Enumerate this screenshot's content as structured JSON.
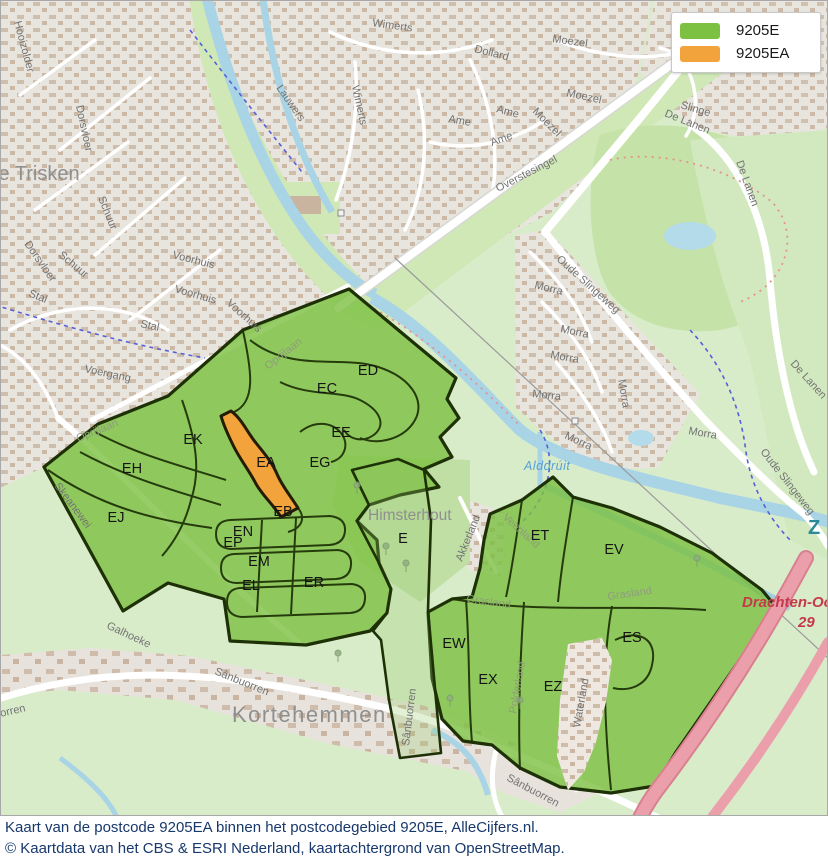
{
  "legend": {
    "items": [
      {
        "label": "9205E",
        "color": "#7cc141"
      },
      {
        "label": "9205EA",
        "color": "#f2a33c"
      }
    ]
  },
  "caption": {
    "line1": "Kaart van de postcode 9205EA binnen het postcodegebied 9205E, AlleCijfers.nl.",
    "line2": "© Kaartdata van het CBS & ESRI Nederland, kaartachtergrond van OpenStreetMap."
  },
  "map": {
    "regions": {
      "ed": "ED",
      "ec": "EC",
      "ee": "EE",
      "ek": "EK",
      "eh": "EH",
      "ej": "EJ",
      "ea": "EA",
      "eg": "EG",
      "eb": "EB",
      "en": "EN",
      "ep": "EP",
      "em": "EM",
      "el": "EL",
      "er": "ER",
      "e": "E",
      "et": "ET",
      "ev": "EV",
      "ew": "EW",
      "ex": "EX",
      "ez": "EZ",
      "es": "ES"
    },
    "places": {
      "de_trisken": "De Trisken",
      "himsterhout": "Himsterhout",
      "kortehemmen": "Kortehemmen",
      "z": "Z"
    },
    "water": {
      "alddruit": "Alddrúit"
    },
    "motorway": {
      "name": "Drachten-Oost",
      "exit": "29"
    },
    "streets": {
      "hooizolder": "Hooizolder",
      "slinge_a": "Slinge",
      "slinge_b": "Slinge",
      "wimerts_a": "Wimerts",
      "wimerts_b": "Wimerts",
      "lauwers": "Lauwers",
      "dollard": "Dollard",
      "moezel_a": "Moezel",
      "moezel_b": "Moezel",
      "moezel_c": "Moezel",
      "ame_a": "Ame",
      "ame_b": "Ame",
      "ame_c": "Ame",
      "overstesingel": "Overstesingel",
      "dorsvloer_a": "Dorsvloer",
      "dorsvloer_b": "Dorsvloer",
      "schuur_a": "Schuur",
      "schuur_b": "Schuur",
      "voorhuis_a": "Voorhuis",
      "voorhuis_b": "Voorhuis",
      "voorhuis_c": "Voorhuis",
      "stal_a": "Stal",
      "stal_b": "Stal",
      "voergang": "Voergang",
      "oprijlaan_a": "Oprijlaan",
      "oprijlaan_b": "Oprijlaan",
      "skeanewei": "Skeanewei",
      "galhoeke": "Galhoeke",
      "sanbuorren_a": "Sânbuorren",
      "sanbuorren_b": "Sânbuorren",
      "sanbuorren_c": "Sânbuorren",
      "sanbuorren_d": "Sânbuorren",
      "morra_a": "Morra",
      "morra_b": "Morra",
      "morra_c": "Morra",
      "morra_d": "Morra",
      "morra_e": "Morra",
      "morra_f": "Morra",
      "morra_g": "Morra",
      "oude_slingeweg_a": "Oude Slingeweg",
      "oude_slingeweg_b": "Oude Slingeweg",
      "de_lanen_a": "De Lanen",
      "de_lanen_b": "De Lanen",
      "de_lanen_c": "De Lanen",
      "akkerland": "Akkerland",
      "polderland": "Polderland",
      "waterland": "Waterland",
      "veenland": "Veenland",
      "grasland_a": "Grasland",
      "grasland_b": "Grasland"
    }
  }
}
